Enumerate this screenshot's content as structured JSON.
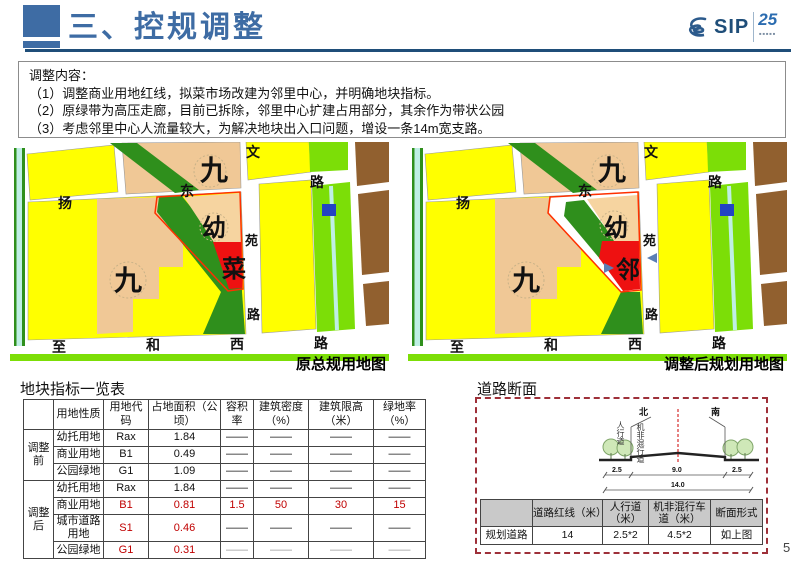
{
  "header": {
    "title": "三、控规调整",
    "logo": {
      "name": "SIP",
      "anniversary": "25"
    }
  },
  "content_box": {
    "lines": [
      "调整内容：",
      "（1）调整商业用地红线，拟菜市场改建为邻里中心，并明确地块指标。",
      "（2）原绿带为高压走廊，目前已拆除，邻里中心扩建占用部分，其余作为带状公园",
      "（3）考虑邻里中心人流量较大，为解决地块出入口问题，增设一条14m宽支路。"
    ]
  },
  "maps": {
    "left": {
      "caption": "原总规用地图",
      "labels": {
        "nine_top": "九",
        "wen": "文",
        "lu_top": "路",
        "yang": "扬",
        "dong": "东",
        "you": "幼",
        "yuan": "苑",
        "parcel": "菜",
        "nine": "九",
        "lu_mid": "路",
        "zhi": "至",
        "he": "和",
        "xi": "西",
        "lu_bottom": "路"
      }
    },
    "right": {
      "caption": "调整后规划用地图",
      "labels": {
        "nine_top": "九",
        "wen": "文",
        "lu_top": "路",
        "yang": "扬",
        "dong": "东",
        "you": "幼",
        "yuan": "苑",
        "parcel": "邻",
        "nine": "九",
        "lu_mid": "路",
        "zhi": "至",
        "he": "和",
        "xi": "西",
        "lu_bottom": "路"
      }
    },
    "colors": {
      "residential_yellow": "#FFFF00",
      "school_tan": "#F0C896",
      "kindergarten_tan": "#F6D4A0",
      "green_belt": "#2F8F1C",
      "park_green": "#7CDE07",
      "canal_cyan": "#BFEFE4",
      "water_blue": "#2343C3",
      "industry_brown": "#91602F",
      "commercial_red": "#EE1111",
      "red_line": "#FF3000"
    }
  },
  "indicator_table": {
    "title": "地块指标一览表",
    "headers": [
      "",
      "用地性质",
      "用地代码",
      "占地面积（公顷）",
      "容积率",
      "建筑密度（%）",
      "建筑限高（米）",
      "绿地率（%）"
    ],
    "groups": [
      {
        "label": "调整前",
        "rows": [
          [
            "幼托用地",
            "Rax",
            "1.84",
            "——",
            "——",
            "——",
            "——"
          ],
          [
            "商业用地",
            "B1",
            "0.49",
            "——",
            "——",
            "——",
            "——"
          ],
          [
            "公园绿地",
            "G1",
            "1.09",
            "——",
            "——",
            "——",
            "——"
          ]
        ]
      },
      {
        "label": "调整后",
        "rows": [
          [
            "幼托用地",
            "Rax",
            "1.84",
            "——",
            "——",
            "——",
            "——"
          ],
          [
            "商业用地",
            "B1",
            "0.81",
            "1.5",
            "50",
            "30",
            "15"
          ],
          [
            "城市道路用地",
            "S1",
            "0.46",
            "——",
            "——",
            "——",
            "——"
          ],
          [
            "公园绿地",
            "G1",
            "0.31",
            "——",
            "——",
            "——",
            "——"
          ]
        ]
      }
    ]
  },
  "road_section": {
    "title": "道路断面",
    "diagram": {
      "north": "北",
      "south": "南",
      "sidewalk": "人行道",
      "mixed_lane": "机非混行道",
      "dims": [
        "2.5",
        "9.0",
        "2.5"
      ],
      "total": "14.0",
      "centerline_color": "#CC0000"
    },
    "table": {
      "headers": [
        "",
        "道路红线（米）",
        "人行道（米）",
        "机非混行车道（米）",
        "断面形式"
      ],
      "row": [
        "规划道路",
        "14",
        "2.5*2",
        "4.5*2",
        "如上图"
      ]
    }
  },
  "page": {
    "number": "5"
  }
}
